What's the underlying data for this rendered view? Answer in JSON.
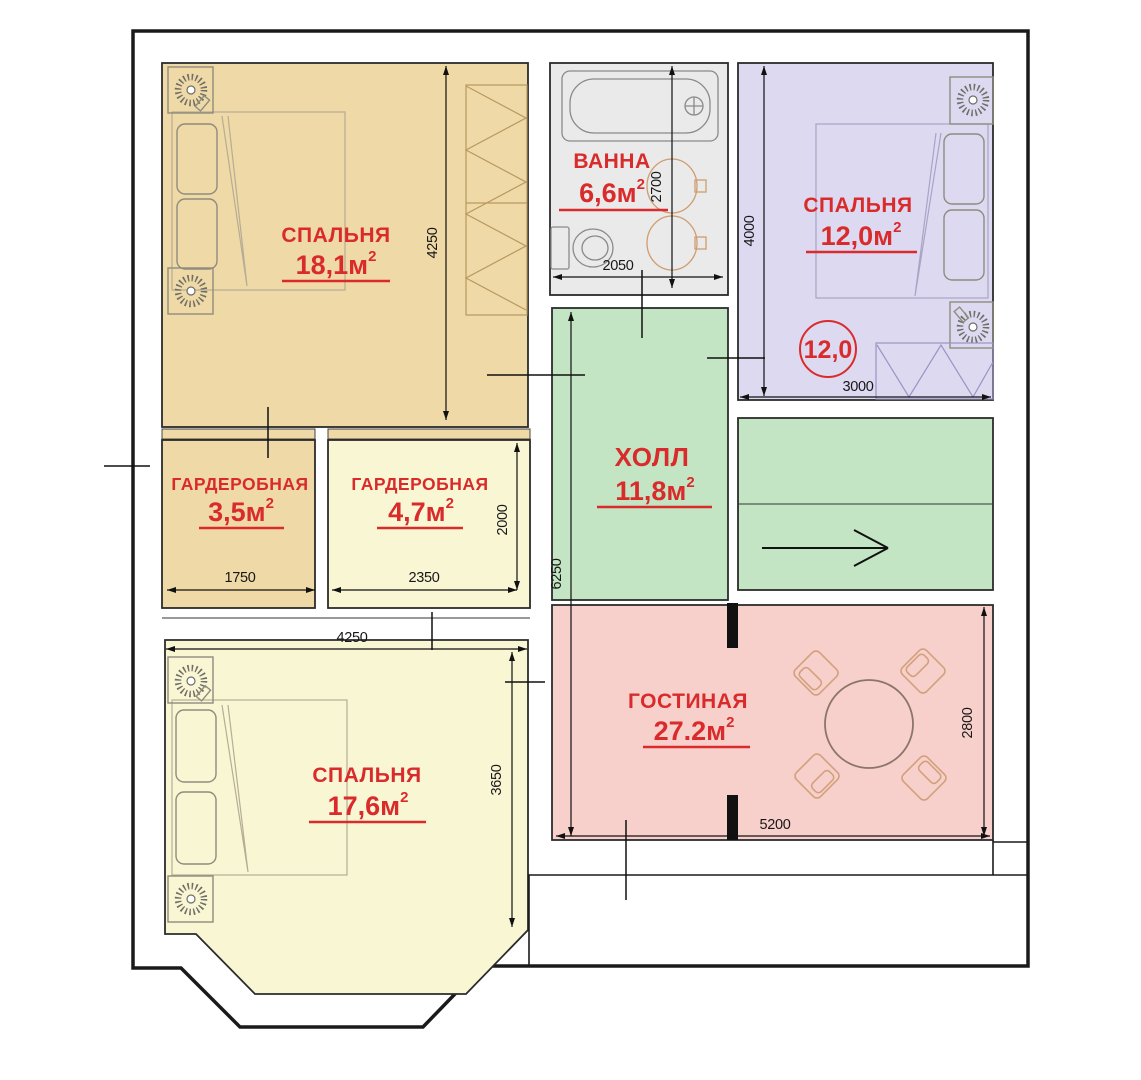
{
  "figure": "apartment-floor-plan",
  "palette": {
    "wall": "#1a1a1a",
    "label_red": "#d92b2b",
    "furniture_stroke": "#8f8c7e",
    "accent_furniture": "#d2a17c"
  },
  "rooms": {
    "bedroom1": {
      "name": "СПАЛЬНЯ",
      "area": "18,1м",
      "sup": "2",
      "color": "#efd9a6"
    },
    "bathroom": {
      "name": "ВАННА",
      "area": "6,6м",
      "sup": "2",
      "color": "#eaeaea"
    },
    "bedroom2": {
      "name": "СПАЛЬНЯ",
      "area": "12,0м",
      "sup": "2",
      "color": "#dcd9f1",
      "circle_label": "12,0"
    },
    "hall": {
      "name": "ХОЛЛ",
      "area": "11,8м",
      "sup": "2",
      "color": "#c3e5c3"
    },
    "wardrobe1": {
      "name": "ГАРДЕРОБНАЯ",
      "area": "3,5м",
      "sup": "2",
      "color": "#efd9a6"
    },
    "wardrobe2": {
      "name": "ГАРДЕРОБНАЯ",
      "area": "4,7м",
      "sup": "2",
      "color": "#f9f6d4"
    },
    "bedroom3": {
      "name": "СПАЛЬНЯ",
      "area": "17,6м",
      "sup": "2",
      "color": "#f9f6d4"
    },
    "living": {
      "name": "ГОСТИНАЯ",
      "area": "27.2м",
      "sup": "2",
      "color": "#f8d0cb"
    }
  },
  "dimensions": {
    "bedroom1_height": "4250",
    "bath_width": "2050",
    "bath_height": "2700",
    "bedroom2_height": "4000",
    "bedroom2_width": "3000",
    "wardrobe1_width": "1750",
    "wardrobe2_width": "2350",
    "wardrobe2_height": "2000",
    "hall_height": "6250",
    "bedroom3_width": "4250",
    "bedroom3_height": "3650",
    "living_width": "5200",
    "living_height": "2800"
  },
  "symbols": {
    "hall_direction_arrow": "right-arrow",
    "lamp_icon": "table-lamp",
    "wardrobe_hatch": "zigzag"
  }
}
